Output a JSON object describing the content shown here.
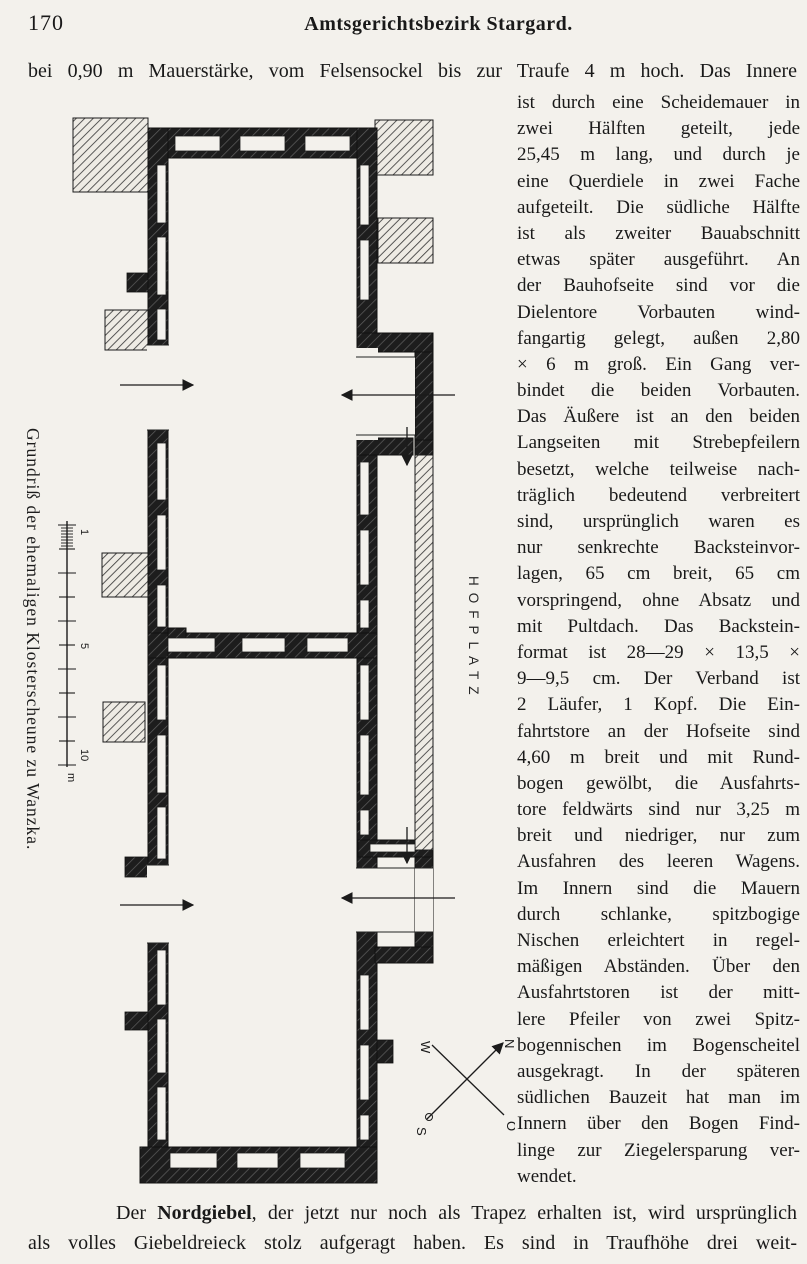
{
  "page": {
    "number": "170",
    "running_header": "Amtsgerichtsbezirk Stargard.",
    "intro_line": "bei 0,90 m Mauerstärke, vom Felsensockel bis zur Traufe 4 m hoch. Das Innere",
    "column_lines": [
      "ist durch eine Scheidemauer in",
      "zwei Hälften geteilt, jede",
      "25,45 m lang, und durch je",
      "eine Querdiele in zwei Fache",
      "aufgeteilt. Die südliche Hälfte",
      "ist als zweiter Bauabschnitt",
      "etwas später ausgeführt. An",
      "der Bauhofseite sind vor die",
      "Dielentore Vorbauten wind-",
      "fangartig gelegt, außen 2,80",
      "× 6 m groß. Ein Gang ver-",
      "bindet die beiden Vorbauten.",
      "Das Äußere ist an den beiden",
      "Langseiten mit Strebepfeilern",
      "besetzt, welche teilweise nach-",
      "träglich bedeutend verbreitert",
      "sind, ursprünglich waren es",
      "nur senkrechte Backsteinvor-",
      "lagen, 65 cm breit, 65 cm",
      "vorspringend, ohne Absatz und",
      "mit Pultdach. Das Backstein-",
      "format ist 28—29 × 13,5 ×",
      "9—9,5 cm. Der Verband ist",
      "2 Läufer, 1 Kopf. Die Ein-",
      "fahrtstore an der Hofseite sind",
      "4,60 m breit und mit Rund-",
      "bogen gewölbt, die Ausfahrts-",
      "tore feldwärts sind nur 3,25 m",
      "breit und niedriger, nur zum",
      "Ausfahren des leeren Wagens.",
      "Im Innern sind die Mauern",
      "durch schlanke, spitzbogige",
      "Nischen erleichtert in regel-",
      "mäßigen Abständen. Über den",
      "Ausfahrtstoren ist der mitt-",
      "lere Pfeiler von zwei Spitz-",
      "bogennischen im Bogenscheitel",
      "ausgekragt. In der späteren",
      "südlichen Bauzeit hat man im",
      "Innern über den Bogen Find-",
      "linge zur Ziegelersparung ver-",
      "wendet."
    ],
    "closing": {
      "lead": "Der ",
      "bold": "Nordgiebel",
      "line1_rest": ", der jetzt nur noch als Trapez erhalten ist, wird ursprünglich",
      "line2": "als volles Giebeldreieck stolz aufgeragt haben. Es sind in Traufhöhe drei weit-"
    }
  },
  "figure": {
    "side_caption": "Grundriß der ehemaligen Klosterscheune zu Wanzka.",
    "courtyard_label": "HOFPLATZ",
    "compass": {
      "north": "N",
      "east": "O",
      "south": "S",
      "west": "W"
    },
    "scale": {
      "mark_1": "1",
      "mark_5": "5",
      "mark_10": "10",
      "unit": "m"
    },
    "ink_color": "#1b1b1b",
    "paper_color": "#f3f1ec"
  }
}
